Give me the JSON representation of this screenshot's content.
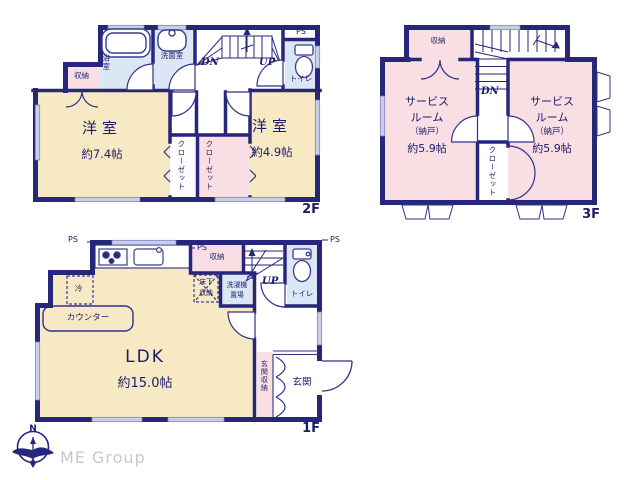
{
  "colors": {
    "wall": "#26267b",
    "room_cream": "#f6e9c4",
    "room_pink": "#f9dee3",
    "room_blue": "#dbe7f4",
    "window": "#c9cfe8",
    "text": "#1c1c6b",
    "logo_gray": "#c9c9cb"
  },
  "f2": {
    "floor": "2F",
    "storage": "収納",
    "bath": "浴室",
    "washroom": "洗面室",
    "ps": "PS",
    "toilet": "トイレ",
    "dn": "DN",
    "up": "UP",
    "bed1_name": "洋室",
    "bed1_size": "約7.4帖",
    "bed2_name": "洋室",
    "bed2_size": "約4.9帖",
    "closet_left": "クローゼット",
    "closet_right": "クローゼット"
  },
  "f3": {
    "floor": "3F",
    "storage": "収納",
    "dn": "DN",
    "room1_line1": "サービス",
    "room1_line2": "ルーム",
    "room1_line3": "（納戸）",
    "room1_line4": "約5.9帖",
    "room2_line1": "サービス",
    "room2_line2": "ルーム",
    "room2_line3": "（納戸）",
    "room2_line4": "約5.9帖",
    "closet": "クローゼット"
  },
  "f1": {
    "floor": "1F",
    "ps_left": "PS",
    "ps_mid": "PS",
    "ps_right": "PS",
    "storage": "収納",
    "underfloor_line1": "床下",
    "underfloor_line2": "収納",
    "laundry_line1": "洗濯機",
    "laundry_line2": "置場",
    "fridge": "冷",
    "counter": "カウンター",
    "up": "UP",
    "toilet": "トイレ",
    "ldk_name": "LDK",
    "ldk_size": "約15.0帖",
    "entrance_storage": "玄関収納",
    "entrance": "玄関"
  },
  "footer": {
    "north": "N",
    "company": "ME Group"
  }
}
